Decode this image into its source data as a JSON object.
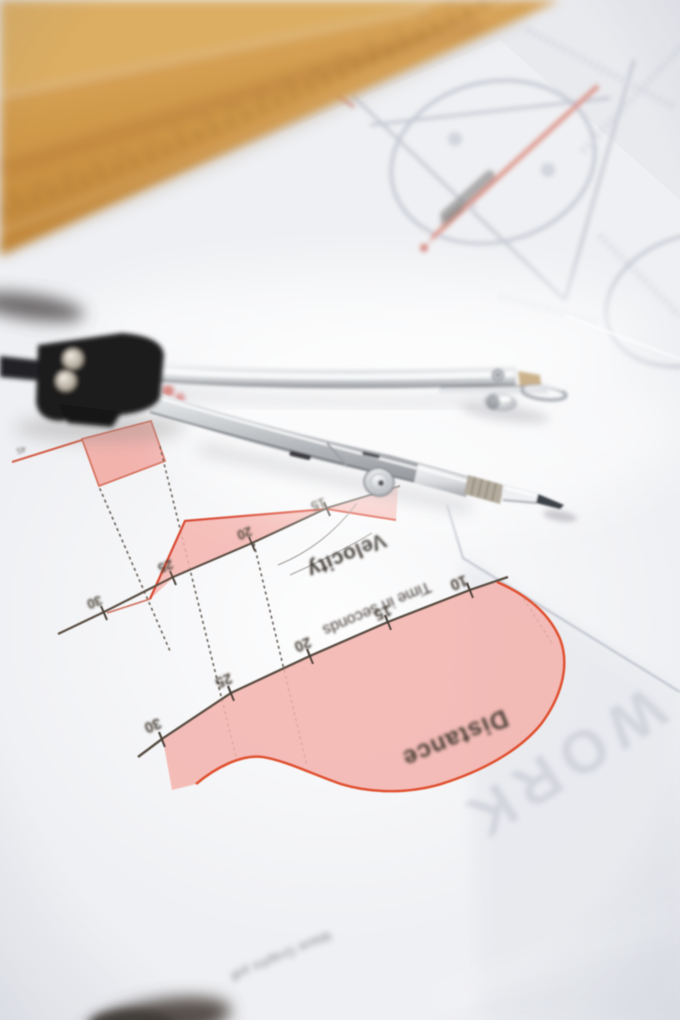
{
  "photo": {
    "objects": [
      "wooden-set-square",
      "wooden-ruler",
      "drafting-compass",
      "worksheet-paper",
      "background-diagram-sheet",
      "under-paper"
    ],
    "colors": {
      "paper": "#f1f2f5",
      "background_paper": "#e9eaee",
      "wood": "#c98f44",
      "chart_fill_pink": "#f4b4ae",
      "chart_line_red": "#df5433",
      "axis_ink": "#544a40",
      "metal_silver": "#b7babe",
      "hinge_plastic_black": "#1b1b1f"
    }
  },
  "charts": {
    "velocity": {
      "label": "Velocity",
      "ticks": [
        "30",
        "25",
        "20",
        "15"
      ]
    },
    "distance": {
      "label": "Distance",
      "axis_label": "Time in seconds",
      "ticks": [
        "30",
        "25",
        "20",
        "15",
        "10"
      ]
    },
    "corner_number": "45"
  },
  "background": {
    "watermark": "WORK",
    "footer_text": "Wave Graphs pdf"
  },
  "chart_data": [
    {
      "type": "area",
      "title": "Velocity",
      "xlabel": "Time in seconds",
      "x_ticks": [
        15,
        20,
        25,
        30
      ],
      "x": [
        10,
        15,
        20,
        24,
        26,
        27,
        30
      ],
      "y": [
        1.6,
        0,
        -1.4,
        -2.9,
        -1.2,
        0,
        0
      ],
      "ylabel": "",
      "y_units": "relative (axis unlabeled)",
      "fill": "#f4b4ae",
      "line": "#d94a30",
      "note_layout": "printed upside-down in photo, page rotated ~157deg"
    },
    {
      "type": "area",
      "title": "Distance",
      "xlabel": "Time in seconds",
      "x_ticks": [
        10,
        15,
        20,
        25,
        30
      ],
      "x": [
        9.5,
        11,
        13,
        15,
        18,
        21,
        24,
        26,
        28,
        30
      ],
      "y": [
        0,
        1.5,
        2.7,
        3.0,
        2.6,
        1.9,
        1.55,
        1.75,
        1.4,
        1.2
      ],
      "ylabel": "",
      "y_units": "relative (axis unlabeled)",
      "fill": "#f4b4ae",
      "line": "#e0512f",
      "note_layout": "printed upside-down in photo, page rotated ~157deg"
    }
  ]
}
